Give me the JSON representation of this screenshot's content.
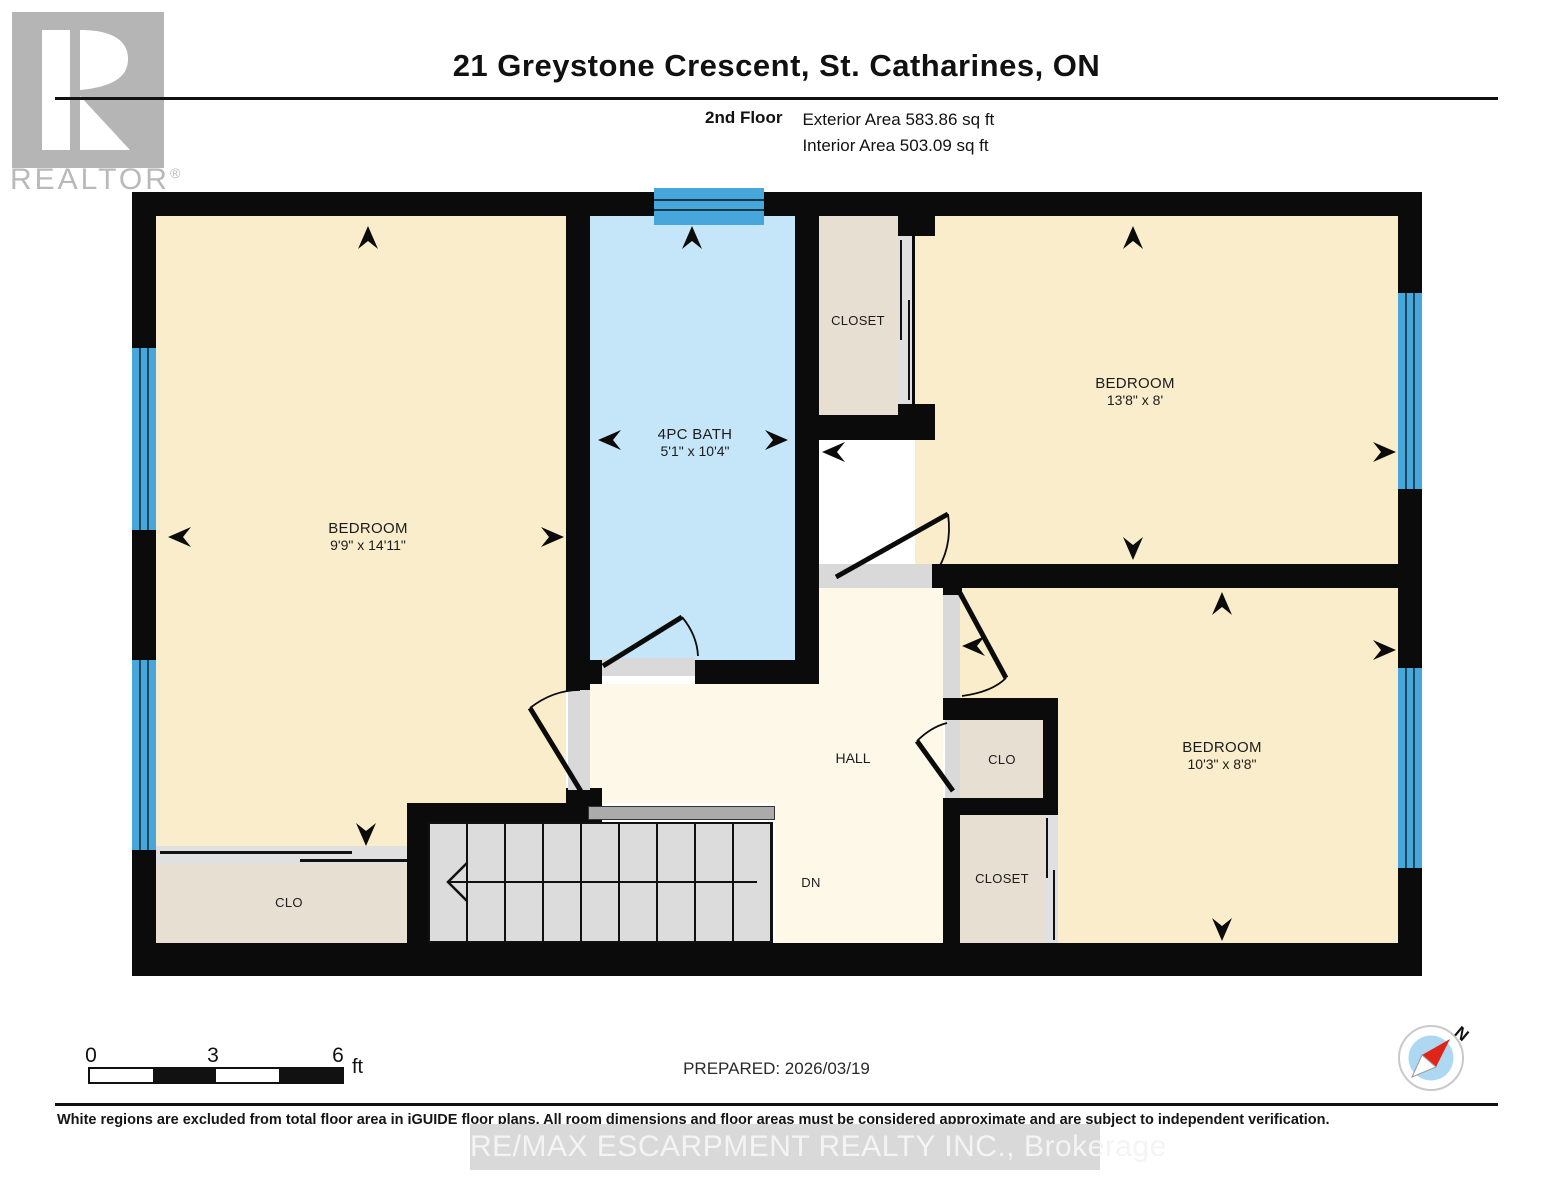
{
  "header": {
    "title": "21 Greystone Crescent, St. Catharines, ON",
    "floor_label": "2nd Floor",
    "exterior_area": "Exterior Area 583.86 sq ft",
    "interior_area": "Interior Area 503.09 sq ft"
  },
  "logo": {
    "brand": "REALTOR",
    "registered": "®"
  },
  "rooms": {
    "bedroom_left": {
      "name": "BEDROOM",
      "dims": "9'9\" x 14'11\""
    },
    "bath": {
      "name": "4PC BATH",
      "dims": "5'1\" x 10'4\""
    },
    "bedroom_top_right": {
      "name": "BEDROOM",
      "dims": "13'8\" x 8'"
    },
    "bedroom_right": {
      "name": "BEDROOM",
      "dims": "10'3\" x 8'8\""
    },
    "closet_top": {
      "name": "CLOSET"
    },
    "clo_right": {
      "name": "CLO"
    },
    "closet_bottom_right": {
      "name": "CLOSET"
    },
    "clo_bottom_left": {
      "name": "CLO"
    },
    "hall": {
      "name": "HALL"
    },
    "stairs": {
      "label": "DN"
    }
  },
  "scale_bar": {
    "tick_0": "0",
    "tick_3": "3",
    "tick_6": "6",
    "unit": "ft"
  },
  "compass": {
    "north_label": "N"
  },
  "footer": {
    "prepared": "PREPARED: 2026/03/19",
    "disclaimer": "White regions are excluded from total floor area in iGUIDE floor plans. All room dimensions and floor areas must be considered approximate and are subject to independent verification.",
    "watermark": "RE/MAX ESCARPMENT REALTY INC., Brokerage"
  },
  "colors": {
    "wall": "#0b0b0b",
    "bedroom_fill": "#FAEDCB",
    "hall_fill": "#FDF8E7",
    "bath_fill": "#C5E6F8",
    "closet_fill": "#E7DFD2",
    "window_blue": "#47A7DB",
    "stairs_gray": "#DCDCDC",
    "logo_gray": "#B5B5B5"
  }
}
